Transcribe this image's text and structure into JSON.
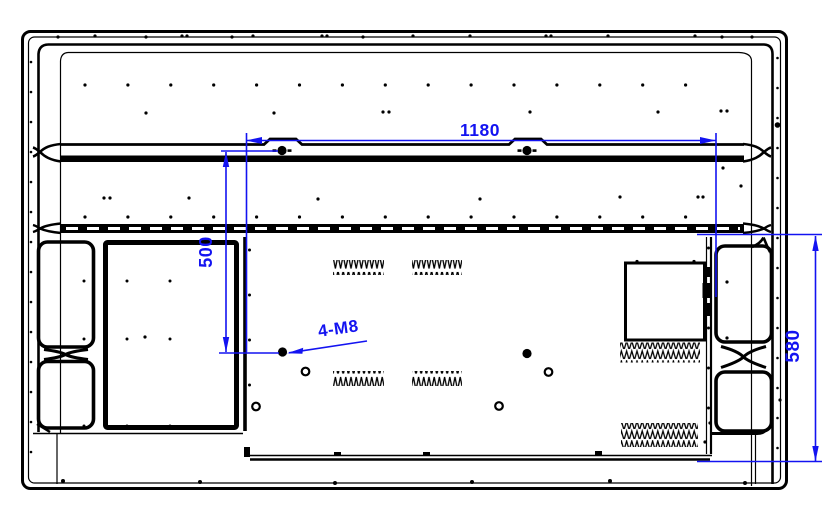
{
  "drawing": {
    "type": "technical-drawing",
    "subject": "flat-panel-display-rear-view-with-mounting-dimensions",
    "background": "#ffffff",
    "colors": {
      "line": "#000000",
      "dimension": "#1313f1"
    },
    "dimensions": {
      "mount_width": "1180",
      "mount_vertical_spacing": "500",
      "plate_height": "580",
      "hole_callout": "4-M8"
    }
  }
}
